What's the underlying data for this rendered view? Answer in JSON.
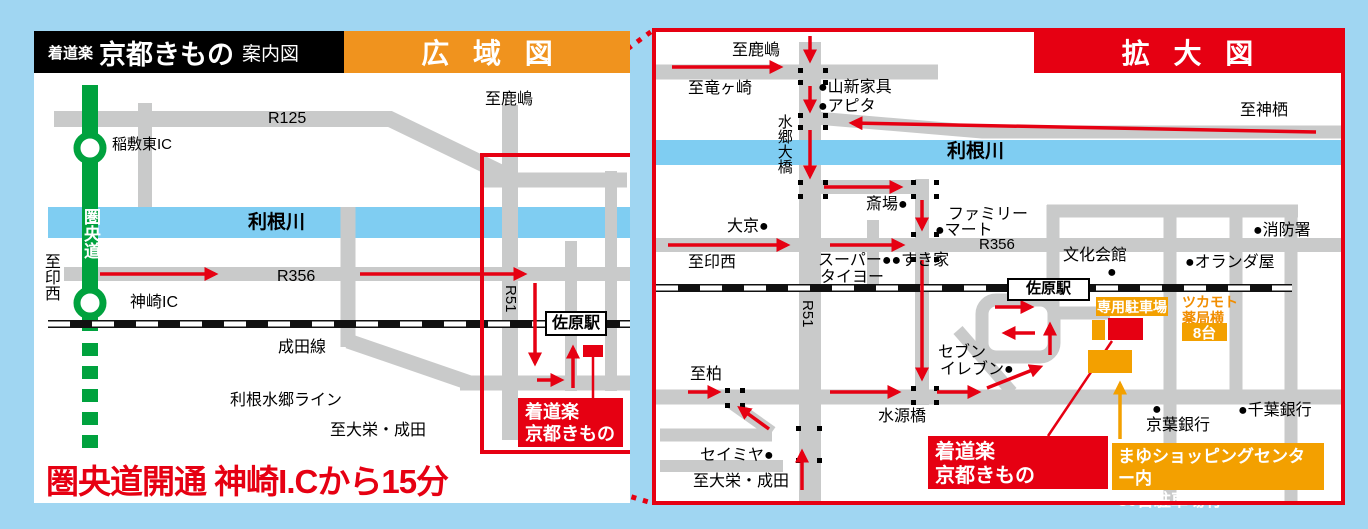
{
  "colors": {
    "background": "#a0d6f2",
    "accent_red": "#e60012",
    "accent_orange_bar": "#f0931e",
    "accent_orange_box": "#f3a000",
    "expressway_green": "#00a23e",
    "road_gray": "#c9caca",
    "river_blue": "#7fcdf2"
  },
  "header": {
    "brand_small": "着道楽",
    "brand_large": "京都きもの",
    "brand_suffix": "案内図",
    "wide_title": "広域図",
    "detail_title": "拡大図"
  },
  "wide_map": {
    "note": "圏央道開通 神崎I.Cから15分",
    "shop": {
      "line1": "着道楽",
      "line2": "京都きもの"
    },
    "labels": [
      {
        "n": "label-to-kashima",
        "t": "至鹿嶋",
        "x": 451,
        "y": 60,
        "s": 16
      },
      {
        "n": "label-route-r125",
        "t": "R125",
        "x": 234,
        "y": 79,
        "s": 16
      },
      {
        "n": "label-inashiki-higashi-ic",
        "t": "稲敷東IC",
        "x": 78,
        "y": 106,
        "s": 15
      },
      {
        "n": "label-kenodo-expressway",
        "t": "圏央道",
        "x": 47,
        "y": 177,
        "s": 17,
        "c": "#fff",
        "b": true,
        "v": true
      },
      {
        "n": "label-tone-river",
        "t": "利根川",
        "x": 214,
        "y": 181,
        "s": 19,
        "b": true
      },
      {
        "n": "label-to-inzai",
        "t": "至印西",
        "x": 7,
        "y": 222,
        "s": 16,
        "v": true
      },
      {
        "n": "label-route-r356",
        "t": "R356",
        "x": 243,
        "y": 237,
        "s": 16
      },
      {
        "n": "label-kozaki-ic",
        "t": "神崎IC",
        "x": 96,
        "y": 263,
        "s": 16
      },
      {
        "n": "label-route-r51",
        "t": "R51",
        "x": 484,
        "y": 254,
        "s": 15,
        "r": 90
      },
      {
        "n": "label-sawara-station",
        "t": "佐原駅",
        "x": 511,
        "y": 280,
        "s": 16,
        "b": true,
        "bg": "#fff",
        "bd": "2px solid #000",
        "w": 62,
        "h": 25,
        "ctr": true
      },
      {
        "n": "label-narita-line",
        "t": "成田線",
        "x": 244,
        "y": 308,
        "s": 16
      },
      {
        "n": "label-tone-suigo-line",
        "t": "利根水郷ライン",
        "x": 196,
        "y": 361,
        "s": 16
      },
      {
        "n": "label-to-taiei-narita",
        "t": "至大栄・成田",
        "x": 296,
        "y": 391,
        "s": 16
      }
    ]
  },
  "detail_map": {
    "shop": {
      "line1": "着道楽",
      "line2": "京都きもの"
    },
    "parking_badge": "専用駐車場",
    "pharmacy": {
      "line1": "ツカモト",
      "line2": "薬局横",
      "badge": "8台"
    },
    "mayu": {
      "line1": "まゆショッピングセンター内",
      "line2": "30台駐車場有"
    },
    "labels": [
      {
        "n": "label-to-kashima",
        "t": "至鹿嶋",
        "x": 80,
        "y": 14,
        "s": 16
      },
      {
        "n": "label-to-tatsugasaki",
        "t": "至竜ヶ崎",
        "x": 36,
        "y": 52,
        "s": 16
      },
      {
        "n": "label-yamashin-furniture",
        "t": "●山新家具",
        "x": 166,
        "y": 51,
        "s": 16
      },
      {
        "n": "label-apita",
        "t": "●アピタ",
        "x": 166,
        "y": 70,
        "s": 16
      },
      {
        "n": "label-to-kamisu",
        "t": "至神栖",
        "x": 588,
        "y": 74,
        "s": 16
      },
      {
        "n": "label-suigo-ohashi-bridge",
        "t": "水郷大橋",
        "x": 123,
        "y": 86,
        "s": 15,
        "v": true
      },
      {
        "n": "label-tone-river",
        "t": "利根川",
        "x": 295,
        "y": 113,
        "s": 19,
        "b": true
      },
      {
        "n": "label-saijo",
        "t": "斎場●",
        "x": 214,
        "y": 168,
        "s": 16
      },
      {
        "n": "label-family-mart-1",
        "t": "ファミリー",
        "x": 296,
        "y": 178,
        "s": 16
      },
      {
        "n": "label-family-mart-2",
        "t": "●マート",
        "x": 283,
        "y": 194,
        "s": 16
      },
      {
        "n": "label-daikyo",
        "t": "大京●",
        "x": 75,
        "y": 190,
        "s": 16
      },
      {
        "n": "label-fire-station",
        "t": "●消防署",
        "x": 601,
        "y": 194,
        "s": 16
      },
      {
        "n": "label-bunka-kaikan",
        "t": "文化会館",
        "x": 411,
        "y": 219,
        "s": 16
      },
      {
        "n": "label-bunka-kaikan-dot",
        "t": "●",
        "x": 455,
        "y": 236,
        "s": 16
      },
      {
        "n": "label-oranda-ya",
        "t": "●オランダ屋",
        "x": 533,
        "y": 226,
        "s": 16
      },
      {
        "n": "label-route-r356",
        "t": "R356",
        "x": 327,
        "y": 209,
        "s": 15
      },
      {
        "n": "label-to-inzai",
        "t": "至印西",
        "x": 36,
        "y": 226,
        "s": 16
      },
      {
        "n": "label-super-taiyo-sukiya",
        "t": "スーパー●●すき家",
        "x": 166,
        "y": 224,
        "s": 16
      },
      {
        "n": "label-super-taiyo-2",
        "t": "タイヨー",
        "x": 168,
        "y": 241,
        "s": 16
      },
      {
        "n": "label-route-r51",
        "t": "R51",
        "x": 163,
        "y": 272,
        "s": 15,
        "r": 90
      },
      {
        "n": "label-sawara-station",
        "t": "佐原駅",
        "x": 355,
        "y": 250,
        "s": 15,
        "b": true,
        "bg": "#fff",
        "bd": "2px solid #000",
        "w": 83,
        "h": 23,
        "ctr": true
      },
      {
        "n": "label-to-kashiwa",
        "t": "至柏",
        "x": 38,
        "y": 338,
        "s": 16
      },
      {
        "n": "label-seven-eleven-1",
        "t": "セブン",
        "x": 286,
        "y": 316,
        "s": 16
      },
      {
        "n": "label-seven-eleven-2",
        "t": "イレブン●",
        "x": 288,
        "y": 333,
        "s": 16
      },
      {
        "n": "label-suigenbashi-bridge",
        "t": "水源橋",
        "x": 226,
        "y": 380,
        "s": 16
      },
      {
        "n": "label-seimiya",
        "t": "セイミヤ●",
        "x": 48,
        "y": 419,
        "s": 16
      },
      {
        "n": "label-to-taiei-narita",
        "t": "至大栄・成田",
        "x": 41,
        "y": 445,
        "s": 16
      },
      {
        "n": "label-keiyo-bank-dot",
        "t": "●",
        "x": 500,
        "y": 373,
        "s": 16
      },
      {
        "n": "label-keiyo-bank",
        "t": "京葉銀行",
        "x": 494,
        "y": 389,
        "s": 16
      },
      {
        "n": "label-chiba-bank",
        "t": "●千葉銀行",
        "x": 586,
        "y": 374,
        "s": 16
      }
    ]
  }
}
